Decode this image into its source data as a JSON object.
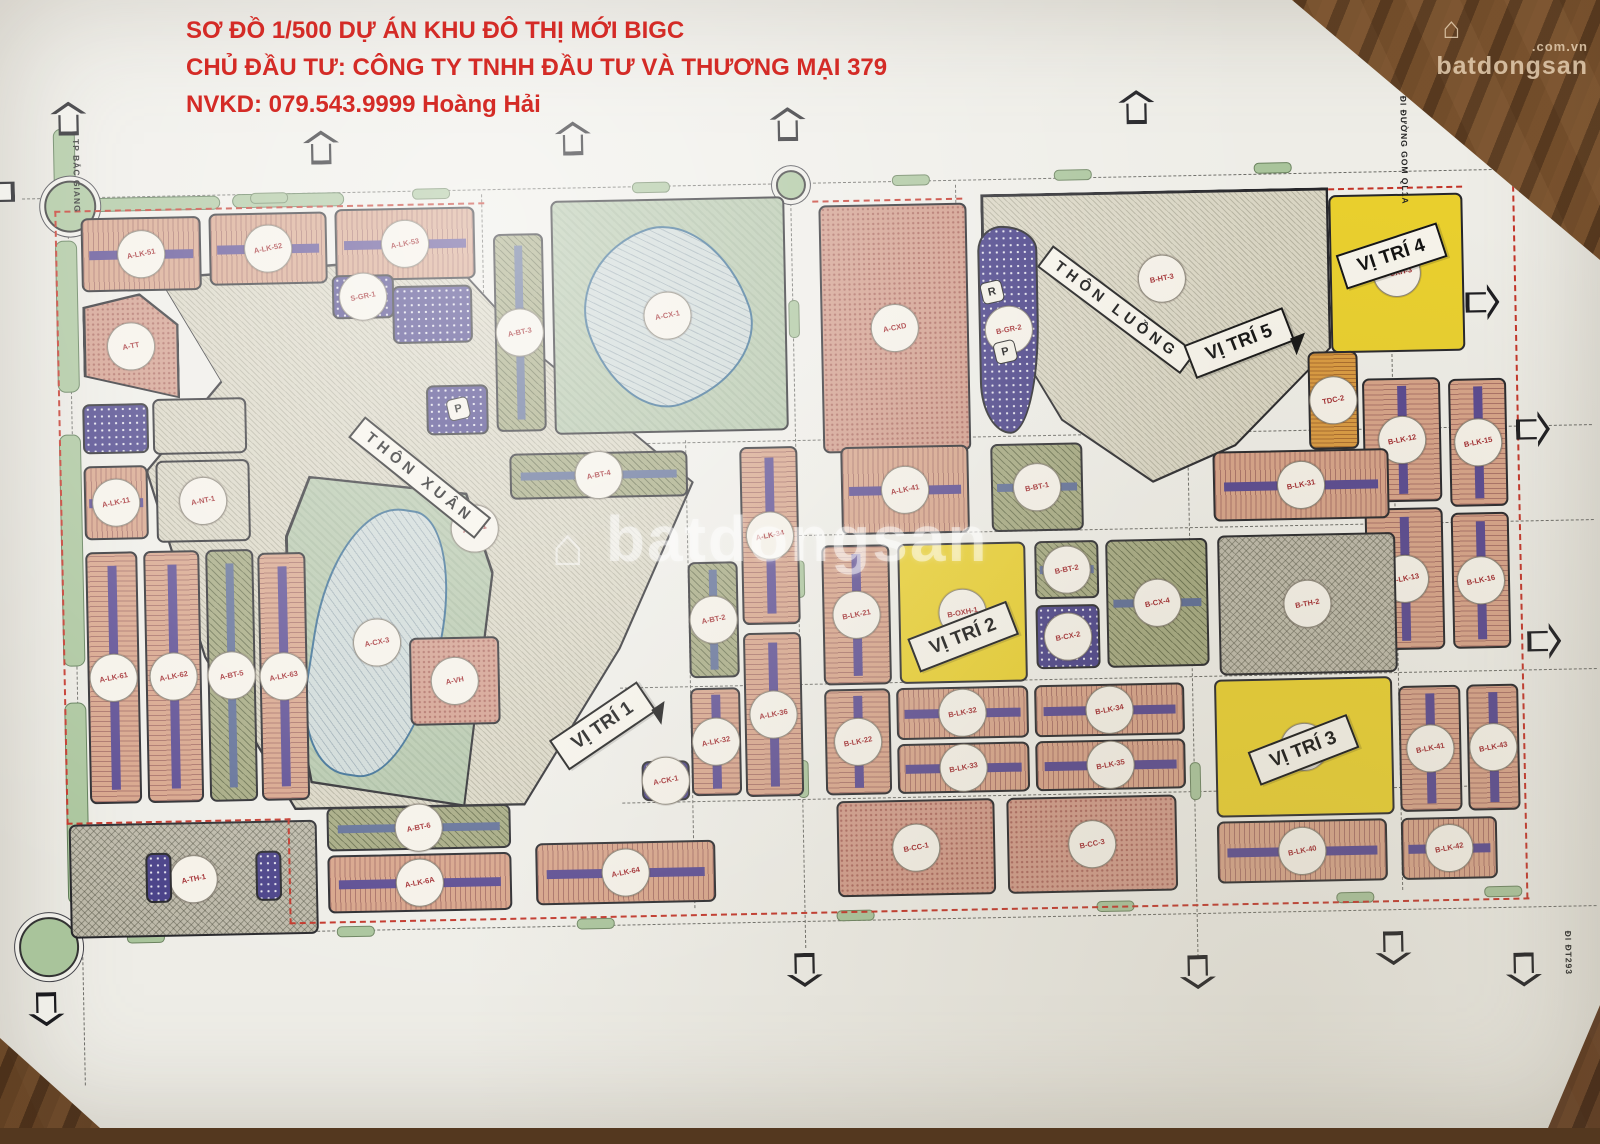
{
  "header": {
    "line1": "SƠ ĐỒ 1/500 DỰ ÁN KHU ĐÔ THỊ MỚI BIGC",
    "line2": "CHỦ ĐẦU TƯ: CÔNG TY TNHH ĐẦU TƯ VÀ THƯƠNG MẠI 379",
    "line3": "NVKD: 079.543.9999 Hoàng Hải",
    "color": "#d42b26"
  },
  "watermark": {
    "brand": "batdongsan",
    "suffix": ".com.vn",
    "house_icon": "⌂",
    "center_brand": "batdongsan"
  },
  "map": {
    "area_labels": [
      {
        "text": "THÔN XUÂN",
        "x": 422,
        "y": 470,
        "rot": 40
      },
      {
        "text": "THÔN LUỒNG",
        "x": 1122,
        "y": 316,
        "rot": 38
      }
    ],
    "vitri_labels": [
      {
        "text": "VỊ TRÍ 1",
        "x": 600,
        "y": 722,
        "rot": -33,
        "tail": true
      },
      {
        "text": "VỊ TRÍ 2",
        "x": 962,
        "y": 640,
        "rot": -20,
        "tail": false
      },
      {
        "text": "VỊ TRÍ 3",
        "x": 1300,
        "y": 760,
        "rot": -20,
        "tail": false
      },
      {
        "text": "VỊ TRÍ 4",
        "x": 1398,
        "y": 268,
        "rot": -17,
        "tail": false
      },
      {
        "text": "VỊ TRÍ 5",
        "x": 1244,
        "y": 352,
        "rot": -20,
        "tail": true
      }
    ],
    "road_labels": [
      {
        "text": "ĐI TT TP BẮC GIANG",
        "x": 80,
        "y": 95
      },
      {
        "text": "ĐI ĐƯỜNG GOM QL1A",
        "x": 1408,
        "y": 108
      },
      {
        "text": "ĐI ĐT293",
        "x": 1556,
        "y": 946
      }
    ],
    "villages": [
      {
        "x": 148,
        "y": 248,
        "w": 548,
        "h": 552,
        "clip": "polygon(3% 3%,56% 0%,72% 18%,100% 42%,86% 72%,68% 100%,26% 100%,10% 72%,0% 38%,14% 22%)"
      },
      {
        "x": 988,
        "y": 198,
        "w": 348,
        "h": 292,
        "clip": "polygon(0 0,100% 0,100% 55%,72% 88%,48% 100%,22% 78%,6% 45%,0 18%)"
      }
    ],
    "parks": [
      {
        "x": 558,
        "y": 196,
        "w": 234,
        "h": 234,
        "type": "park"
      },
      {
        "x": 592,
        "y": 224,
        "w": 162,
        "h": 178,
        "type": "pond",
        "r": "55% 45% 60% 40% / 45% 60% 40% 55%",
        "rot": -18,
        "stamp": "A-CX-1"
      },
      {
        "x": 286,
        "y": 466,
        "w": 208,
        "h": 334,
        "type": "park",
        "clip": "polygon(12% 0,88% 6%,100% 30%,84% 100%,10% 92%,0 55%,0 18%)"
      },
      {
        "x": 312,
        "y": 498,
        "w": 128,
        "h": 272,
        "type": "pond",
        "r": "60% 40% 55% 45% / 55% 45% 65% 35%",
        "rot": 10,
        "stamp": "A-CX-3"
      },
      {
        "x": 152,
        "y": 846,
        "w": 96,
        "h": 40,
        "type": "park"
      }
    ],
    "parcels": [
      {
        "x": 88,
        "y": 204,
        "w": 120,
        "h": 74,
        "type": "lk",
        "stamp": "A-LK-51"
      },
      {
        "x": 216,
        "y": 202,
        "w": 118,
        "h": 72,
        "type": "lk",
        "stamp": "A-LK-52"
      },
      {
        "x": 342,
        "y": 200,
        "w": 140,
        "h": 72,
        "type": "lk",
        "stamp": "A-LK-53"
      },
      {
        "x": 88,
        "y": 280,
        "w": 96,
        "h": 106,
        "type": "cc",
        "stamp": "A-TT",
        "clip": "polygon(0 12%,60% 0,100% 30%,100% 100%,0 78%)"
      },
      {
        "x": 86,
        "y": 390,
        "w": 66,
        "h": 50,
        "type": "gr"
      },
      {
        "x": 156,
        "y": 386,
        "w": 94,
        "h": 56,
        "type": "village"
      },
      {
        "x": 86,
        "y": 452,
        "w": 64,
        "h": 74,
        "type": "lk",
        "stamp": "A-LK-11"
      },
      {
        "x": 158,
        "y": 448,
        "w": 94,
        "h": 82,
        "type": "village",
        "stamp": "A-NT-1"
      },
      {
        "x": 86,
        "y": 538,
        "w": 52,
        "h": 252,
        "type": "lkv",
        "stamp": "A-LK-61"
      },
      {
        "x": 144,
        "y": 538,
        "w": 56,
        "h": 252,
        "type": "lkv",
        "stamp": "A-LK-62"
      },
      {
        "x": 206,
        "y": 538,
        "w": 48,
        "h": 252,
        "type": "btv",
        "stamp": "A-BT-5"
      },
      {
        "x": 258,
        "y": 542,
        "w": 48,
        "h": 248,
        "type": "lkv",
        "stamp": "A-LK-63"
      },
      {
        "x": 64,
        "y": 810,
        "w": 248,
        "h": 114,
        "type": "school",
        "stamp": "A-TH-1"
      },
      {
        "x": 140,
        "y": 840,
        "w": 26,
        "h": 50,
        "type": "gr"
      },
      {
        "x": 250,
        "y": 840,
        "w": 26,
        "h": 50,
        "type": "gr"
      },
      {
        "x": 322,
        "y": 798,
        "w": 184,
        "h": 44,
        "type": "bt",
        "stamp": "A-BT-6"
      },
      {
        "x": 322,
        "y": 846,
        "w": 184,
        "h": 58,
        "type": "lk",
        "stamp": "A-LK-6A"
      },
      {
        "x": 530,
        "y": 838,
        "w": 180,
        "h": 62,
        "type": "lk",
        "stamp": "A-LK-64"
      },
      {
        "x": 338,
        "y": 266,
        "w": 62,
        "h": 44,
        "type": "gr",
        "stamp": "S-GR-1"
      },
      {
        "x": 398,
        "y": 278,
        "w": 80,
        "h": 58,
        "type": "gr"
      },
      {
        "x": 430,
        "y": 378,
        "w": 62,
        "h": 50,
        "type": "gr"
      },
      {
        "x": 500,
        "y": 228,
        "w": 50,
        "h": 198,
        "type": "btv",
        "stamp": "A-BT-3"
      },
      {
        "x": 512,
        "y": 448,
        "w": 178,
        "h": 46,
        "type": "bt",
        "stamp": "A-BT-4"
      },
      {
        "x": 408,
        "y": 630,
        "w": 90,
        "h": 88,
        "type": "cc",
        "stamp": "A-VH"
      },
      {
        "x": 742,
        "y": 446,
        "w": 58,
        "h": 178,
        "type": "lkv",
        "stamp": "A-LK-34"
      },
      {
        "x": 688,
        "y": 560,
        "w": 50,
        "h": 116,
        "type": "btv",
        "stamp": "A-BT-2"
      },
      {
        "x": 742,
        "y": 632,
        "w": 58,
        "h": 164,
        "type": "lkv",
        "stamp": "A-LK-36"
      },
      {
        "x": 688,
        "y": 686,
        "w": 50,
        "h": 108,
        "type": "lkv",
        "stamp": "A-LK-32"
      },
      {
        "x": 638,
        "y": 758,
        "w": 48,
        "h": 40,
        "type": "gr",
        "stamp": "A-CK-1"
      },
      {
        "x": 826,
        "y": 206,
        "w": 148,
        "h": 248,
        "type": "cc",
        "stamp": "A-CXD"
      },
      {
        "x": 984,
        "y": 230,
        "w": 60,
        "h": 208,
        "type": "gr",
        "stamp": "B-GR-2",
        "r": "40% 60% 50% 50% / 12% 12% 55% 25%"
      },
      {
        "x": 1336,
        "y": 206,
        "w": 134,
        "h": 158,
        "type": "yellow",
        "stamp": "B-OXH-3"
      },
      {
        "x": 1312,
        "y": 362,
        "w": 50,
        "h": 98,
        "type": "tdc",
        "stamp": "TDC-2"
      },
      {
        "x": 1366,
        "y": 390,
        "w": 78,
        "h": 124,
        "type": "lkv",
        "stamp": "B-LK-12"
      },
      {
        "x": 1366,
        "y": 520,
        "w": 78,
        "h": 142,
        "type": "lkv",
        "stamp": "B-LK-13"
      },
      {
        "x": 1452,
        "y": 392,
        "w": 58,
        "h": 128,
        "type": "lkv",
        "stamp": "B-LK-15"
      },
      {
        "x": 1452,
        "y": 526,
        "w": 58,
        "h": 136,
        "type": "lkv",
        "stamp": "B-LK-16"
      },
      {
        "x": 843,
        "y": 448,
        "w": 128,
        "h": 88,
        "type": "lk",
        "stamp": "A-LK-41"
      },
      {
        "x": 993,
        "y": 448,
        "w": 92,
        "h": 88,
        "type": "bt",
        "stamp": "B-BT-1"
      },
      {
        "x": 1215,
        "y": 460,
        "w": 176,
        "h": 70,
        "type": "lk",
        "stamp": "B-LK-31"
      },
      {
        "x": 1218,
        "y": 544,
        "w": 178,
        "h": 140,
        "type": "school",
        "stamp": "B-TH-2"
      },
      {
        "x": 822,
        "y": 546,
        "w": 68,
        "h": 140,
        "type": "lkv",
        "stamp": "B-LK-21"
      },
      {
        "x": 898,
        "y": 546,
        "w": 128,
        "h": 140,
        "type": "yellow",
        "stamp": "B-OXH-1"
      },
      {
        "x": 1035,
        "y": 546,
        "w": 64,
        "h": 58,
        "type": "bt",
        "stamp": "B-BT-2"
      },
      {
        "x": 1035,
        "y": 610,
        "w": 64,
        "h": 64,
        "type": "gr",
        "stamp": "B-CX-2"
      },
      {
        "x": 1106,
        "y": 546,
        "w": 102,
        "h": 128,
        "type": "bt",
        "stamp": "B-CX-4"
      },
      {
        "x": 822,
        "y": 690,
        "w": 66,
        "h": 106,
        "type": "lkv",
        "stamp": "B-LK-22"
      },
      {
        "x": 894,
        "y": 690,
        "w": 132,
        "h": 52,
        "type": "lk",
        "stamp": "B-LK-32"
      },
      {
        "x": 894,
        "y": 746,
        "w": 132,
        "h": 50,
        "type": "lk",
        "stamp": "B-LK-33"
      },
      {
        "x": 1032,
        "y": 690,
        "w": 150,
        "h": 52,
        "type": "lk",
        "stamp": "B-LK-34"
      },
      {
        "x": 1032,
        "y": 746,
        "w": 150,
        "h": 50,
        "type": "lk",
        "stamp": "B-LK-35"
      },
      {
        "x": 1212,
        "y": 688,
        "w": 178,
        "h": 138,
        "type": "yellow",
        "stamp": "B-OXH-2"
      },
      {
        "x": 832,
        "y": 802,
        "w": 158,
        "h": 96,
        "type": "cc",
        "stamp": "B-CC-1"
      },
      {
        "x": 1002,
        "y": 802,
        "w": 170,
        "h": 96,
        "type": "cc",
        "stamp": "B-CC-3"
      },
      {
        "x": 1212,
        "y": 830,
        "w": 170,
        "h": 62,
        "type": "lk",
        "stamp": "B-LK-40"
      },
      {
        "x": 1396,
        "y": 698,
        "w": 62,
        "h": 126,
        "type": "lkv",
        "stamp": "B-LK-41"
      },
      {
        "x": 1396,
        "y": 830,
        "w": 96,
        "h": 62,
        "type": "lk",
        "stamp": "B-LK-42"
      },
      {
        "x": 1464,
        "y": 698,
        "w": 52,
        "h": 126,
        "type": "lkv",
        "stamp": "B-LK-43"
      }
    ],
    "loose_stamps": [
      {
        "x": 476,
        "y": 522,
        "code": "A-HT-1"
      },
      {
        "x": 1168,
        "y": 286,
        "code": "B-HT-3"
      }
    ],
    "markers": [
      {
        "x": 998,
        "y": 296,
        "ch": "R"
      },
      {
        "x": 1010,
        "y": 356,
        "ch": "P"
      },
      {
        "x": 462,
        "y": 402,
        "ch": "P"
      }
    ],
    "roundabouts": [
      {
        "x": 76,
        "y": 190,
        "r": 24
      },
      {
        "x": 40,
        "y": 930,
        "r": 28
      },
      {
        "x": 797,
        "y": 183,
        "r": 13
      }
    ],
    "medians": [
      {
        "x": 62,
        "y": 114,
        "w": 20,
        "h": 60
      },
      {
        "x": 62,
        "y": 226,
        "w": 20,
        "h": 150
      },
      {
        "x": 62,
        "y": 420,
        "w": 20,
        "h": 230
      },
      {
        "x": 62,
        "y": 688,
        "w": 20,
        "h": 200
      },
      {
        "x": 96,
        "y": 184,
        "w": 130,
        "h": 12
      },
      {
        "x": 240,
        "y": 183,
        "w": 110,
        "h": 12
      }
    ],
    "green_dashes_h": [
      [
        258,
        182
      ],
      [
        420,
        181
      ],
      [
        640,
        179
      ],
      [
        900,
        177
      ],
      [
        1062,
        175
      ],
      [
        1262,
        172
      ],
      [
        120,
        919
      ],
      [
        330,
        917
      ],
      [
        570,
        914
      ],
      [
        830,
        911
      ],
      [
        1090,
        907
      ],
      [
        1330,
        903
      ],
      [
        1478,
        900
      ]
    ],
    "green_dashes_v": [
      [
        794,
        300
      ],
      [
        794,
        560
      ],
      [
        794,
        760
      ],
      [
        1186,
        560
      ],
      [
        1186,
        770
      ],
      [
        959,
        300
      ]
    ],
    "centerlines_h": [
      [
        30,
        183,
        1545
      ],
      [
        495,
        440,
        1100
      ],
      [
        800,
        535,
        795
      ],
      [
        618,
        684,
        977
      ],
      [
        618,
        799,
        855
      ],
      [
        30,
        921,
        1560
      ]
    ],
    "centerlines_v": [
      [
        75,
        96,
        975
      ],
      [
        798,
        188,
        760
      ],
      [
        963,
        188,
        260
      ],
      [
        489,
        188,
        255
      ],
      [
        688,
        438,
        468
      ],
      [
        1190,
        330,
        640
      ],
      [
        1396,
        336,
        566
      ]
    ],
    "boundary_h": [
      [
        62,
        196,
        430
      ],
      [
        820,
        201,
        150
      ],
      [
        1336,
        199,
        134
      ],
      [
        62,
        808,
        224
      ],
      [
        283,
        912,
        1240
      ]
    ],
    "boundary_v": [
      [
        62,
        196,
        614
      ],
      [
        283,
        808,
        106
      ],
      [
        1520,
        200,
        713
      ]
    ],
    "arrows": [
      {
        "x": 78,
        "y": 104,
        "dir": 0
      },
      {
        "x": 330,
        "y": 138,
        "dir": 0
      },
      {
        "x": 582,
        "y": 134,
        "dir": 0
      },
      {
        "x": 797,
        "y": 124,
        "dir": 0
      },
      {
        "x": 1146,
        "y": 114,
        "dir": 0
      },
      {
        "x": 1442,
        "y": 90,
        "dir": 0
      },
      {
        "x": 6,
        "y": 176,
        "dir": 270
      },
      {
        "x": 1488,
        "y": 316,
        "dir": 90
      },
      {
        "x": 1536,
        "y": 444,
        "dir": 90
      },
      {
        "x": 1543,
        "y": 656,
        "dir": 90
      },
      {
        "x": 797,
        "y": 970,
        "dir": 180
      },
      {
        "x": 1190,
        "y": 980,
        "dir": 180
      },
      {
        "x": 1386,
        "y": 960,
        "dir": 180
      },
      {
        "x": 1516,
        "y": 984,
        "dir": 180
      },
      {
        "x": 38,
        "y": 994,
        "dir": 180
      }
    ]
  },
  "colors": {
    "paper": "#eeede7",
    "wood": "#5e4026",
    "townhouse": "#d6a287",
    "median_purple": "#57478f",
    "villa_olive": "#a3a77e",
    "apartment_pink": "#d09a88",
    "green_space_purple": "#463e86",
    "highlight_yellow": "#e9cf2d",
    "park_green": "#b4c6aa",
    "pond": "#cdd8d6",
    "village_beige": "#d9d5c3",
    "boundary_red": "#c23327",
    "header_red": "#d42b26"
  }
}
